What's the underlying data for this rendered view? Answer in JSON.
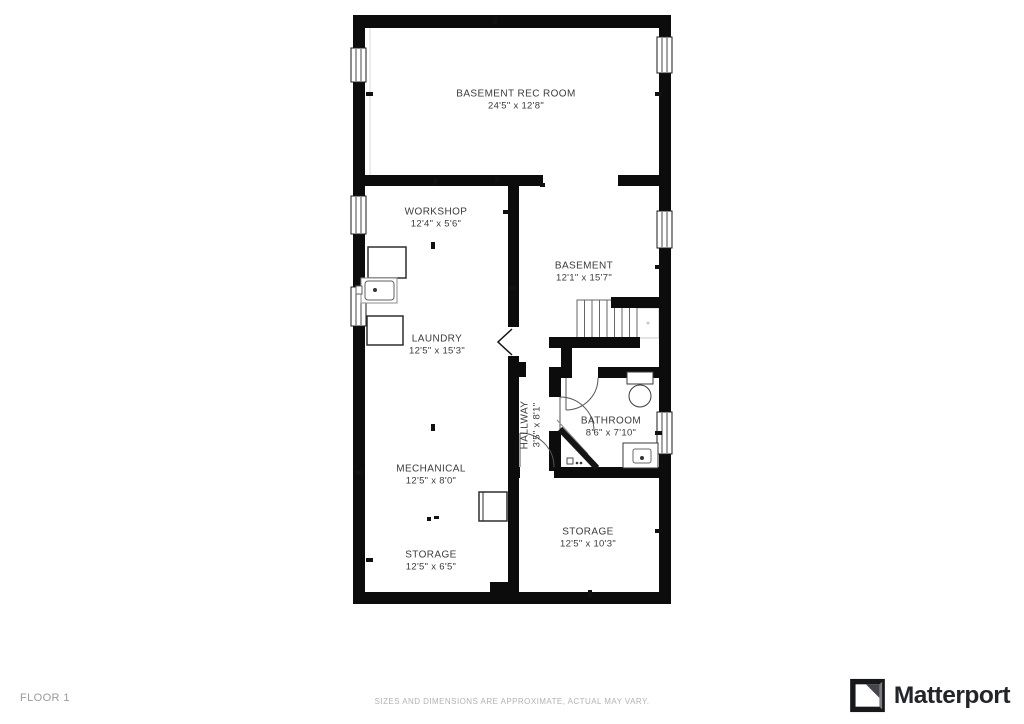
{
  "footer": {
    "floor_label": "FLOOR 1",
    "disclaimer": "SIZES AND DIMENSIONS ARE APPROXIMATE, ACTUAL MAY VARY.",
    "brand_name": "Matterport"
  },
  "colors": {
    "wall": "#0c0c0c",
    "door": "#555555",
    "window_frame": "#1a1a1a",
    "label": "#3b3b3b",
    "tick": "#111111",
    "guide": "#d9d9d9",
    "landing": "#c8c8c8",
    "stair": "#666666"
  },
  "plan": {
    "rooms": [
      {
        "name": "BASEMENT REC ROOM",
        "dims": "24'5\" x 12'8\"",
        "cx": 516,
        "cy": 100,
        "rotate": 0
      },
      {
        "name": "WORKSHOP",
        "dims": "12'4\" x 5'6\"",
        "cx": 436,
        "cy": 218,
        "rotate": 0
      },
      {
        "name": "BASEMENT",
        "dims": "12'1\" x 15'7\"",
        "cx": 584,
        "cy": 272,
        "rotate": 0
      },
      {
        "name": "LAUNDRY",
        "dims": "12'5\" x 15'3\"",
        "cx": 437,
        "cy": 345,
        "rotate": 0
      },
      {
        "name": "HALLWAY",
        "dims": "3'5\" x 8'1\"",
        "cx": 531,
        "cy": 425,
        "rotate": -90
      },
      {
        "name": "BATHROOM",
        "dims": "8'6\" x 7'10\"",
        "cx": 611,
        "cy": 427,
        "rotate": 0
      },
      {
        "name": "MECHANICAL",
        "dims": "12'5\" x 8'0\"",
        "cx": 431,
        "cy": 475,
        "rotate": 0
      },
      {
        "name": "STORAGE",
        "dims": "12'5\" x 6'5\"",
        "cx": 431,
        "cy": 561,
        "rotate": 0
      },
      {
        "name": "STORAGE",
        "dims": "12'5\" x 10'3\"",
        "cx": 588,
        "cy": 538,
        "rotate": 0
      }
    ],
    "walls": [
      [
        353,
        15,
        318,
        13
      ],
      [
        353,
        592,
        318,
        12
      ],
      [
        353,
        15,
        12,
        589
      ],
      [
        659,
        15,
        12,
        589
      ],
      [
        353,
        175,
        190,
        11
      ],
      [
        618,
        175,
        41,
        11
      ],
      [
        508,
        175,
        11,
        152
      ],
      [
        508,
        356,
        11,
        248
      ],
      [
        515,
        362,
        11,
        15
      ],
      [
        490,
        582,
        28,
        22
      ],
      [
        611,
        297,
        48,
        11
      ],
      [
        549,
        337,
        91,
        11
      ],
      [
        561,
        337,
        11,
        41
      ],
      [
        549,
        367,
        17,
        11
      ],
      [
        598,
        367,
        61,
        11
      ],
      [
        549,
        378,
        12,
        19
      ],
      [
        549,
        431,
        12,
        40
      ],
      [
        508,
        467,
        12,
        11
      ],
      [
        554,
        467,
        105,
        11
      ]
    ],
    "windows": [
      [
        351,
        48,
        15,
        34
      ],
      [
        351,
        196,
        15,
        38
      ],
      [
        351,
        287,
        15,
        39
      ],
      [
        657,
        37,
        15,
        36
      ],
      [
        657,
        211,
        15,
        37
      ],
      [
        657,
        412,
        15,
        42
      ]
    ],
    "doors": [
      {
        "leaf": "M566,378 L566,410",
        "arc": "M598,378 A32,32 0 0 1 566,410"
      },
      {
        "leaf": "M560,397 L560,431",
        "arc": "M560,397 A34,34 0 0 1 594,431"
      },
      {
        "leaf": "M520,433 L520,467",
        "arc": "M520,433 A34,34 0 0 1 554,467"
      }
    ],
    "chevron": "M512,329 L498,342 L512,355",
    "shower": {
      "thick": "M560,429 L597,468",
      "thin": "M557,420 L588,454"
    },
    "stairs": {
      "x": 577,
      "y": 300,
      "w": 60,
      "h": 38,
      "treads": 7,
      "landing": [
        637,
        308,
        22,
        30
      ],
      "dot": [
        648,
        323
      ]
    },
    "guide": [
      370,
      28,
      370,
      175
    ],
    "fixtures": {
      "rects": [
        [
          368,
          247,
          38,
          31,
          1.5,
          "#2e2e2e",
          0
        ],
        [
          361,
          278,
          36,
          25,
          1,
          "#8d8d8d",
          0
        ],
        [
          365,
          281,
          29,
          19,
          1,
          "#5f5f5f",
          3
        ],
        [
          356,
          286,
          6,
          8,
          1,
          "#5f5f5f",
          0
        ],
        [
          367,
          316,
          36,
          29,
          1.5,
          "#2e2e2e",
          0
        ],
        [
          479,
          492,
          28,
          29,
          1.5,
          "#2e2e2e",
          0
        ],
        [
          627,
          372,
          26,
          12,
          1,
          "#3a3a3a",
          0
        ],
        [
          623,
          443,
          35,
          25,
          1,
          "#3a3a3a",
          0
        ],
        [
          633,
          449,
          18,
          14,
          1,
          "#6a6a6a",
          2
        ],
        [
          567,
          458,
          6,
          6,
          1,
          "#4a4a4a",
          0
        ]
      ],
      "ellipses": [
        [
          640,
          396,
          11,
          11,
          1,
          "#3a3a3a"
        ]
      ],
      "dots": [
        [
          375,
          290,
          2
        ],
        [
          642,
          458,
          2
        ],
        [
          577,
          463,
          1.3
        ],
        [
          581,
          463,
          1.3
        ]
      ],
      "lines": [
        [
          483,
          492,
          483,
          521,
          1,
          "#2e2e2e"
        ]
      ]
    },
    "ticks": [
      [
        493,
        17,
        4,
        7
      ],
      [
        366,
        92,
        7,
        4
      ],
      [
        655,
        92,
        7,
        4
      ],
      [
        433,
        178,
        4,
        7
      ],
      [
        503,
        210,
        7,
        4
      ],
      [
        431,
        242,
        4,
        7
      ],
      [
        655,
        265,
        7,
        4
      ],
      [
        509,
        286,
        7,
        4
      ],
      [
        431,
        424,
        4,
        7
      ],
      [
        655,
        431,
        7,
        4
      ],
      [
        356,
        471,
        7,
        4
      ],
      [
        427,
        517,
        4,
        4
      ],
      [
        434,
        516,
        5,
        3
      ],
      [
        655,
        529,
        7,
        4
      ],
      [
        588,
        590,
        4,
        7
      ],
      [
        366,
        558,
        7,
        4
      ],
      [
        540,
        183,
        5,
        4
      ],
      [
        495,
        177,
        4,
        5
      ]
    ]
  }
}
